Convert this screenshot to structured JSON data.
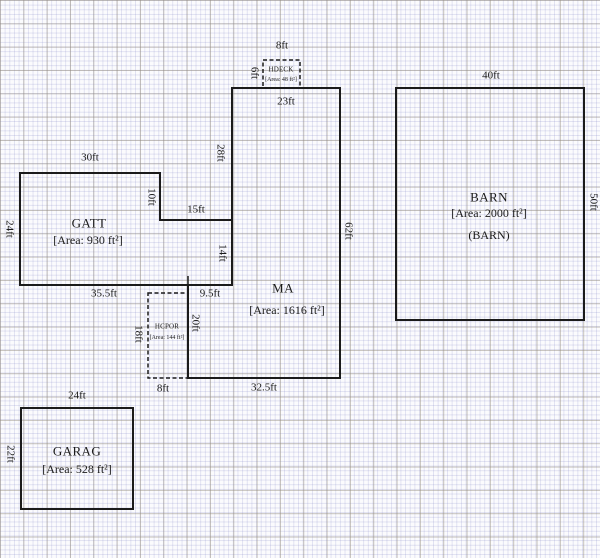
{
  "canvas": {
    "width": 600,
    "height": 558,
    "grid_minor_ft": 1,
    "grid_major_ft": 5,
    "line_color": "#1b1b1b"
  },
  "buildings": {
    "gatt": {
      "name": "GATT",
      "area_label": "[Area: 930 ft²]",
      "dims": {
        "top": "30ft",
        "left": "24ft",
        "notch_v": "10ft",
        "notch_h": "15ft",
        "right_lower": "14ft",
        "bottom": "35.5ft"
      }
    },
    "ma": {
      "name": "MA",
      "area_label": "[Area: 1616 ft²]",
      "dims": {
        "top": "23ft",
        "left_upper": "28ft",
        "right": "62ft",
        "bottom": "32.5ft",
        "bottom_left": "9.5ft",
        "left_lower": "20ft"
      }
    },
    "hdeck": {
      "name": "HDECK",
      "area_label": "[Area: 48 ft²]",
      "dims": {
        "top": "8ft",
        "left": "6ft"
      }
    },
    "hcpor": {
      "name": "HCPOR",
      "area_label": "[Area: 144 ft²]",
      "dims": {
        "left": "18ft",
        "bottom": "8ft"
      }
    },
    "barn": {
      "name": "BARN",
      "area_label": "[Area: 2000 ft²]",
      "sub_label": "(BARN)",
      "dims": {
        "top": "40ft",
        "right": "50ft"
      }
    },
    "garag": {
      "name": "GARAG",
      "area_label": "[Area: 528 ft²]",
      "dims": {
        "top": "24ft",
        "left": "22ft"
      }
    }
  }
}
